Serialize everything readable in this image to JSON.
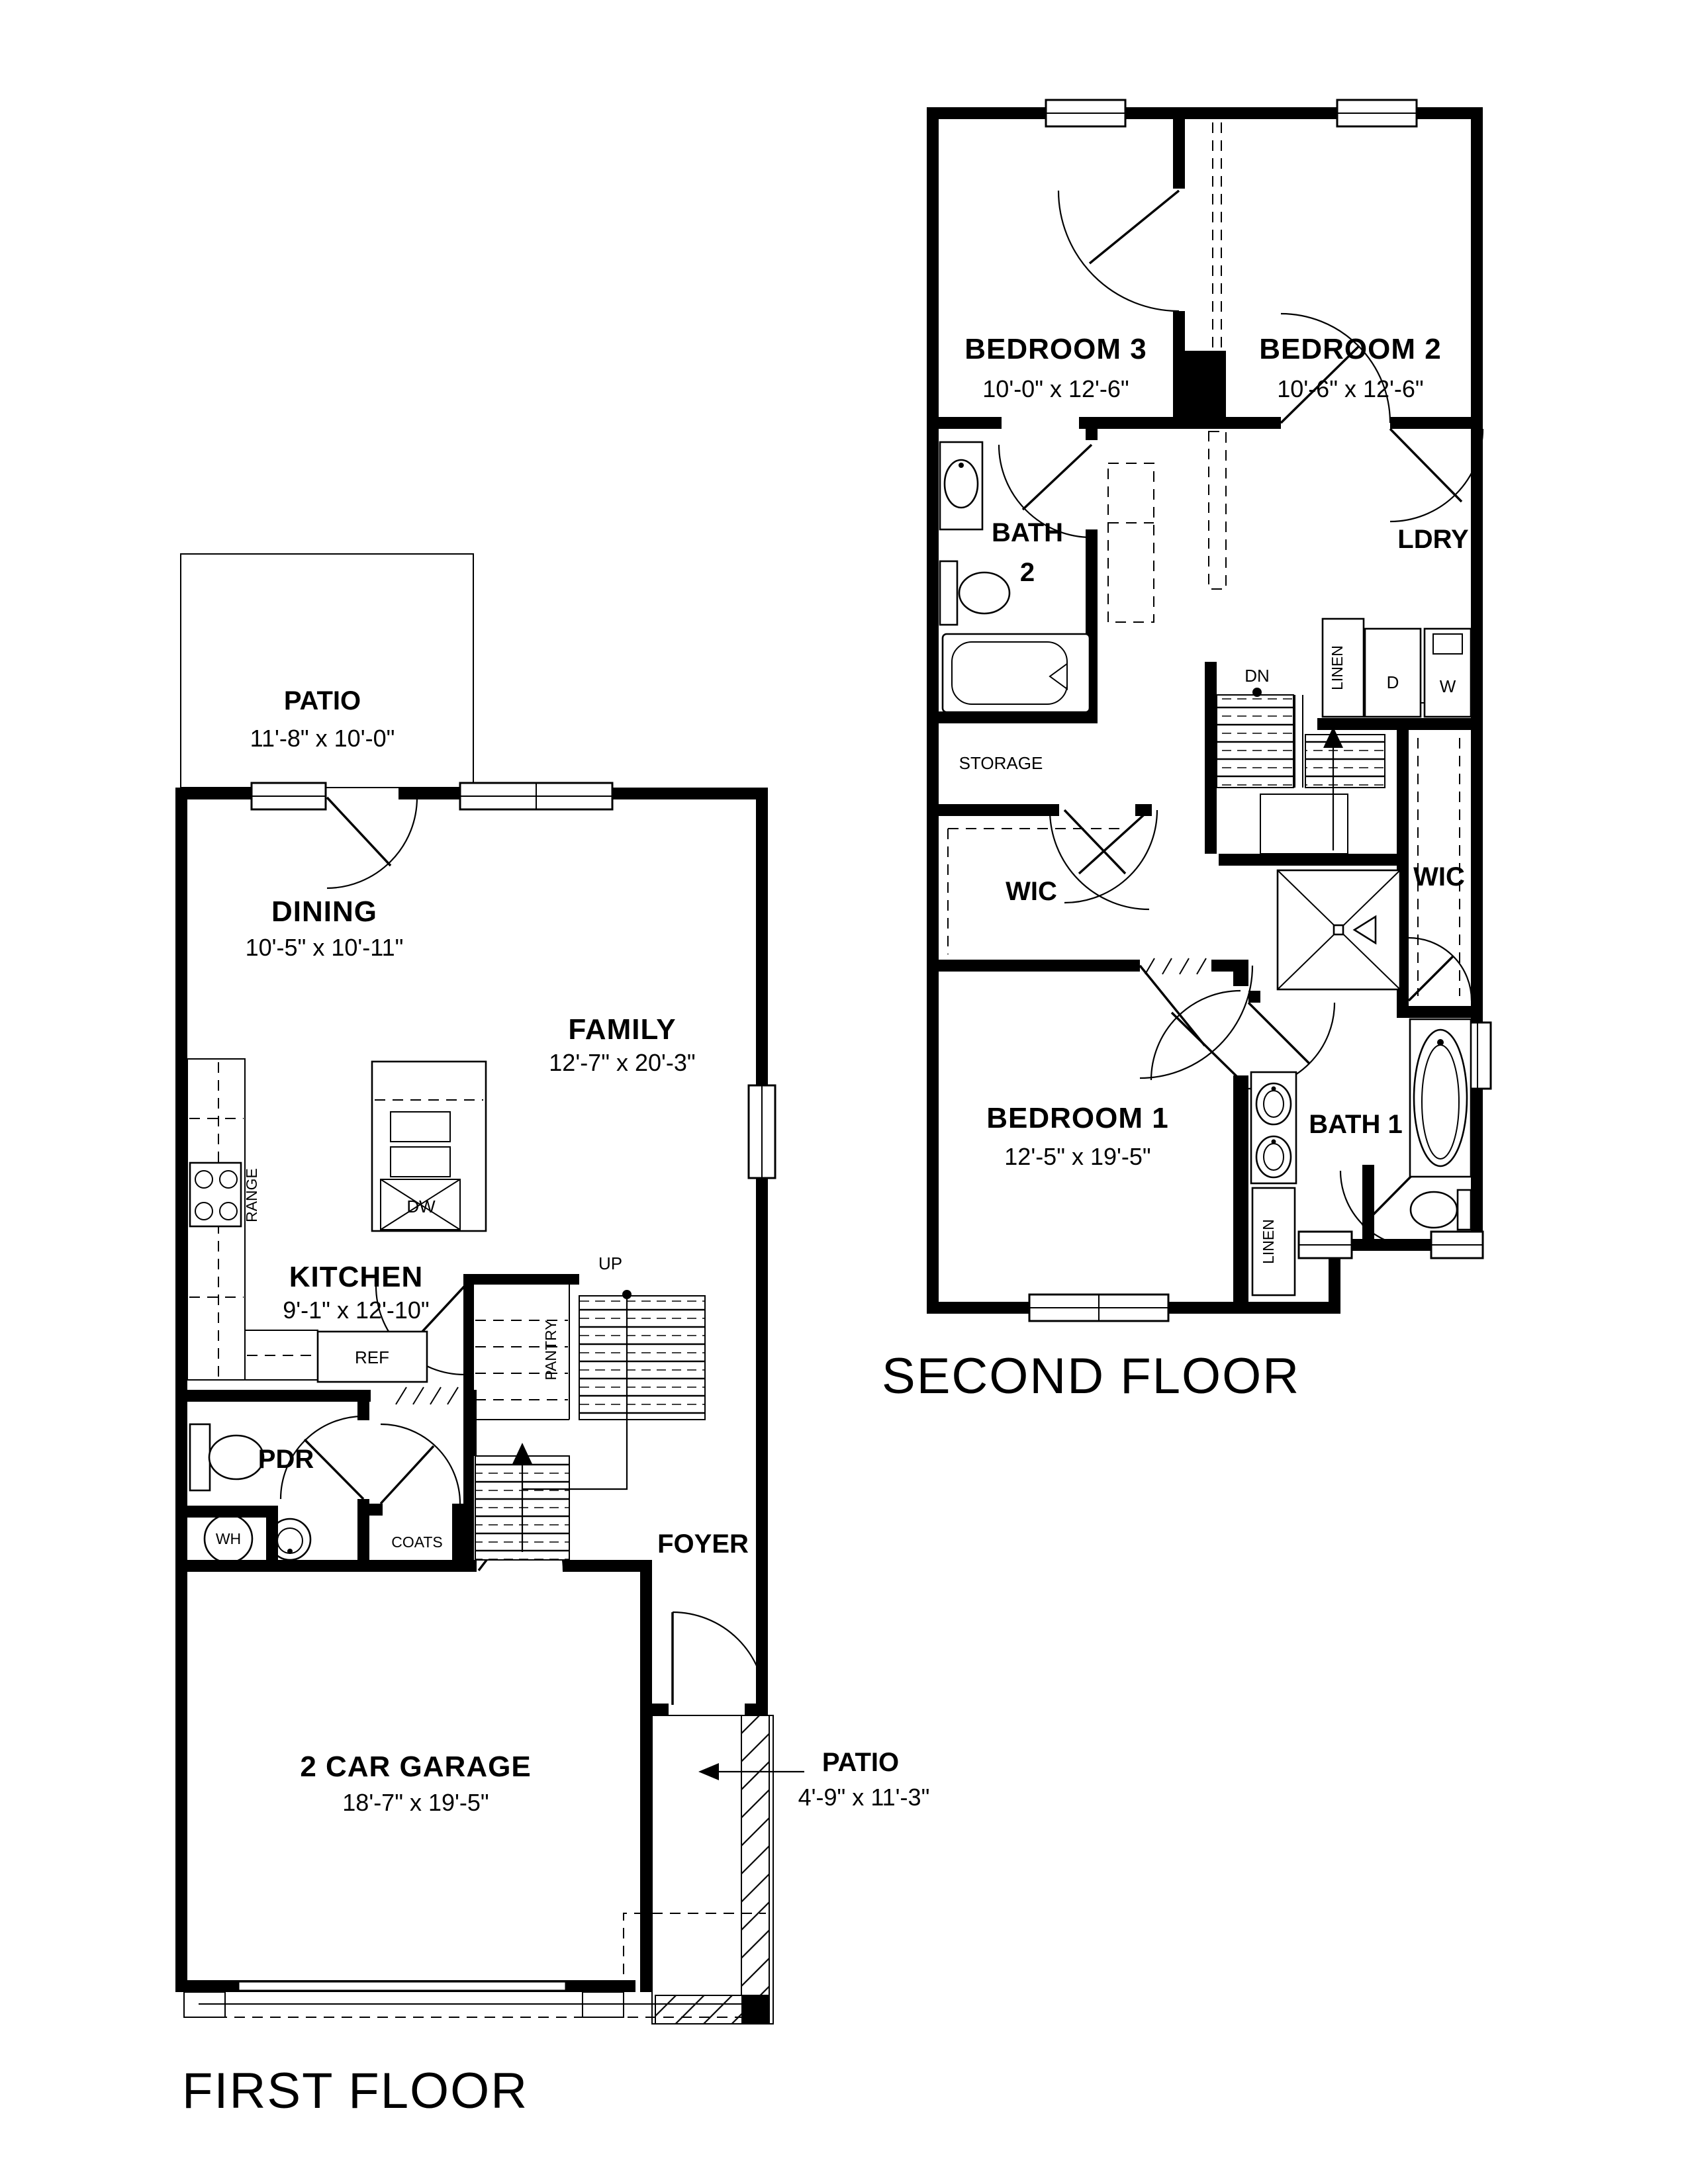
{
  "second_floor": {
    "label": "SECOND FLOOR",
    "bedroom3": {
      "name": "BEDROOM 3",
      "dims": "10'-0\" x 12'-6\""
    },
    "bedroom2": {
      "name": "BEDROOM 2",
      "dims": "10'-6\" x 12'-6\""
    },
    "bath2_line1": "BATH",
    "bath2_line2": "2",
    "ldry": "LDRY",
    "linen_hall": "LINEN",
    "dn": "DN",
    "storage": "STORAGE",
    "wic_left": "WIC",
    "wic_right": "WIC",
    "bedroom1": {
      "name": "BEDROOM 1",
      "dims": "12'-5\" x 19'-5\""
    },
    "bath1": "BATH 1",
    "linen_bath": "LINEN",
    "dryer": "D",
    "washer": "W"
  },
  "first_floor": {
    "label": "FIRST FLOOR",
    "patio_rear": {
      "name": "PATIO",
      "dims": "11'-8\" x 10'-0\""
    },
    "dining": {
      "name": "DINING",
      "dims": "10'-5\" x 10'-11\""
    },
    "family": {
      "name": "FAMILY",
      "dims": "12'-7\" x 20'-3\""
    },
    "kitchen": {
      "name": "KITCHEN",
      "dims": "9'-1\" x 12'-10\""
    },
    "range": "RANGE",
    "dw": "DW",
    "ref": "REF",
    "up": "UP",
    "pantry": "PANTRY",
    "pdr": "PDR",
    "wh": "WH",
    "coats": "COATS",
    "foyer": "FOYER",
    "garage": {
      "name": "2 CAR GARAGE",
      "dims": "18'-7\" x 19'-5\""
    },
    "patio_front": {
      "name": "PATIO",
      "dims": "4'-9\" x 11'-3\""
    }
  }
}
